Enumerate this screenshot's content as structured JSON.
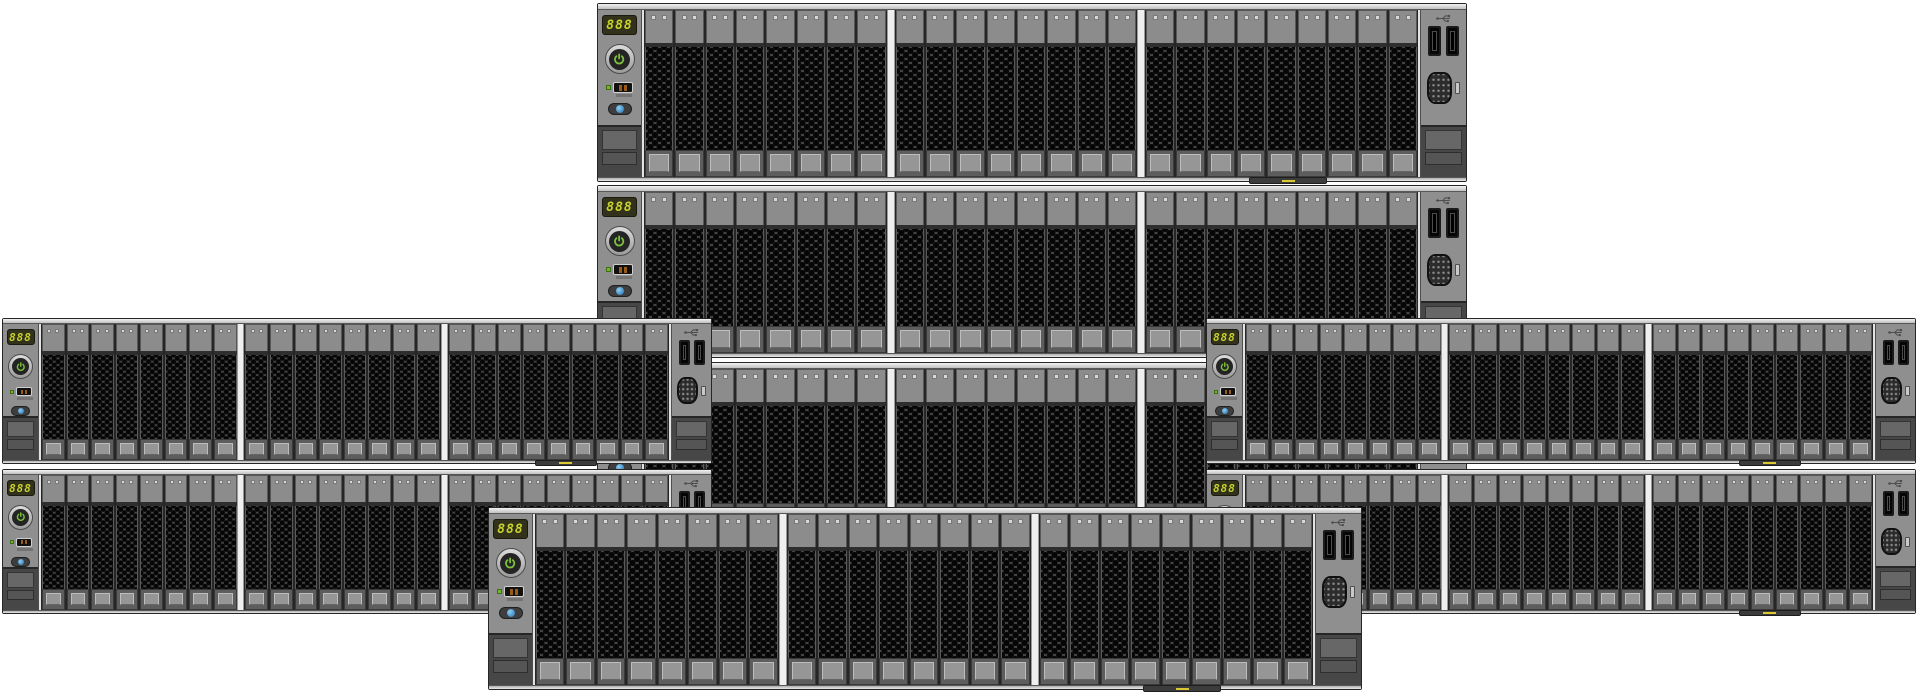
{
  "illustration": {
    "description": "cluster of eight 2U rack servers, front view, stacked in a pyramid arrangement",
    "server": {
      "display_value": "888",
      "drive_groups": [
        8,
        8,
        9
      ],
      "drives_total": 25,
      "leds_per_drive": 2,
      "usb_ports_count": 2,
      "icons": [
        "power-icon",
        "usb-icon",
        "vga-port",
        "uid-led",
        "health-led",
        "asset-tag-led"
      ]
    },
    "colors": {
      "page_bg": "#ffffff",
      "chassis_frame": "#262626",
      "chassis_rail": "#d2d2d2",
      "panel_bg": "#8f8f8f",
      "drive_cap": "#8c8c8c",
      "drive_led": "#d8d8d8",
      "drive_status_bar": "#b2cb2e",
      "drive_vent_bg": "#4a4a4a",
      "drive_hole": "#050505",
      "display_bg": "#31311c",
      "display_digits": "#c9d42b",
      "power_glyph": "#7cc03c",
      "health_led": "#72b62d",
      "uid_blue": "#3a9ad9",
      "group_divider": "#efefef",
      "latch": "#474747",
      "asset_tag_bar": "#3c3c3c",
      "asset_tag_led": "#d9c832"
    },
    "servers": [
      {
        "id": "center-row-3",
        "x": 597,
        "y": 362,
        "w": 870,
        "h": 173,
        "size": "lg",
        "z": 0
      },
      {
        "id": "center-row-2",
        "x": 597,
        "y": 185,
        "w": 870,
        "h": 173,
        "size": "lg",
        "z": 1
      },
      {
        "id": "center-row-1",
        "x": 597,
        "y": 3,
        "w": 870,
        "h": 179,
        "size": "lg",
        "z": 2
      },
      {
        "id": "left-upper",
        "x": 2,
        "y": 318,
        "w": 710,
        "h": 146,
        "size": "sm",
        "z": 3
      },
      {
        "id": "left-lower",
        "x": 2,
        "y": 469,
        "w": 710,
        "h": 145,
        "size": "sm",
        "z": 3
      },
      {
        "id": "right-upper",
        "x": 1206,
        "y": 318,
        "w": 710,
        "h": 146,
        "size": "sm",
        "z": 3
      },
      {
        "id": "right-lower",
        "x": 1206,
        "y": 469,
        "w": 710,
        "h": 145,
        "size": "sm",
        "z": 3
      },
      {
        "id": "bottom-center",
        "x": 488,
        "y": 507,
        "w": 874,
        "h": 183,
        "size": "xl",
        "z": 4
      }
    ]
  }
}
